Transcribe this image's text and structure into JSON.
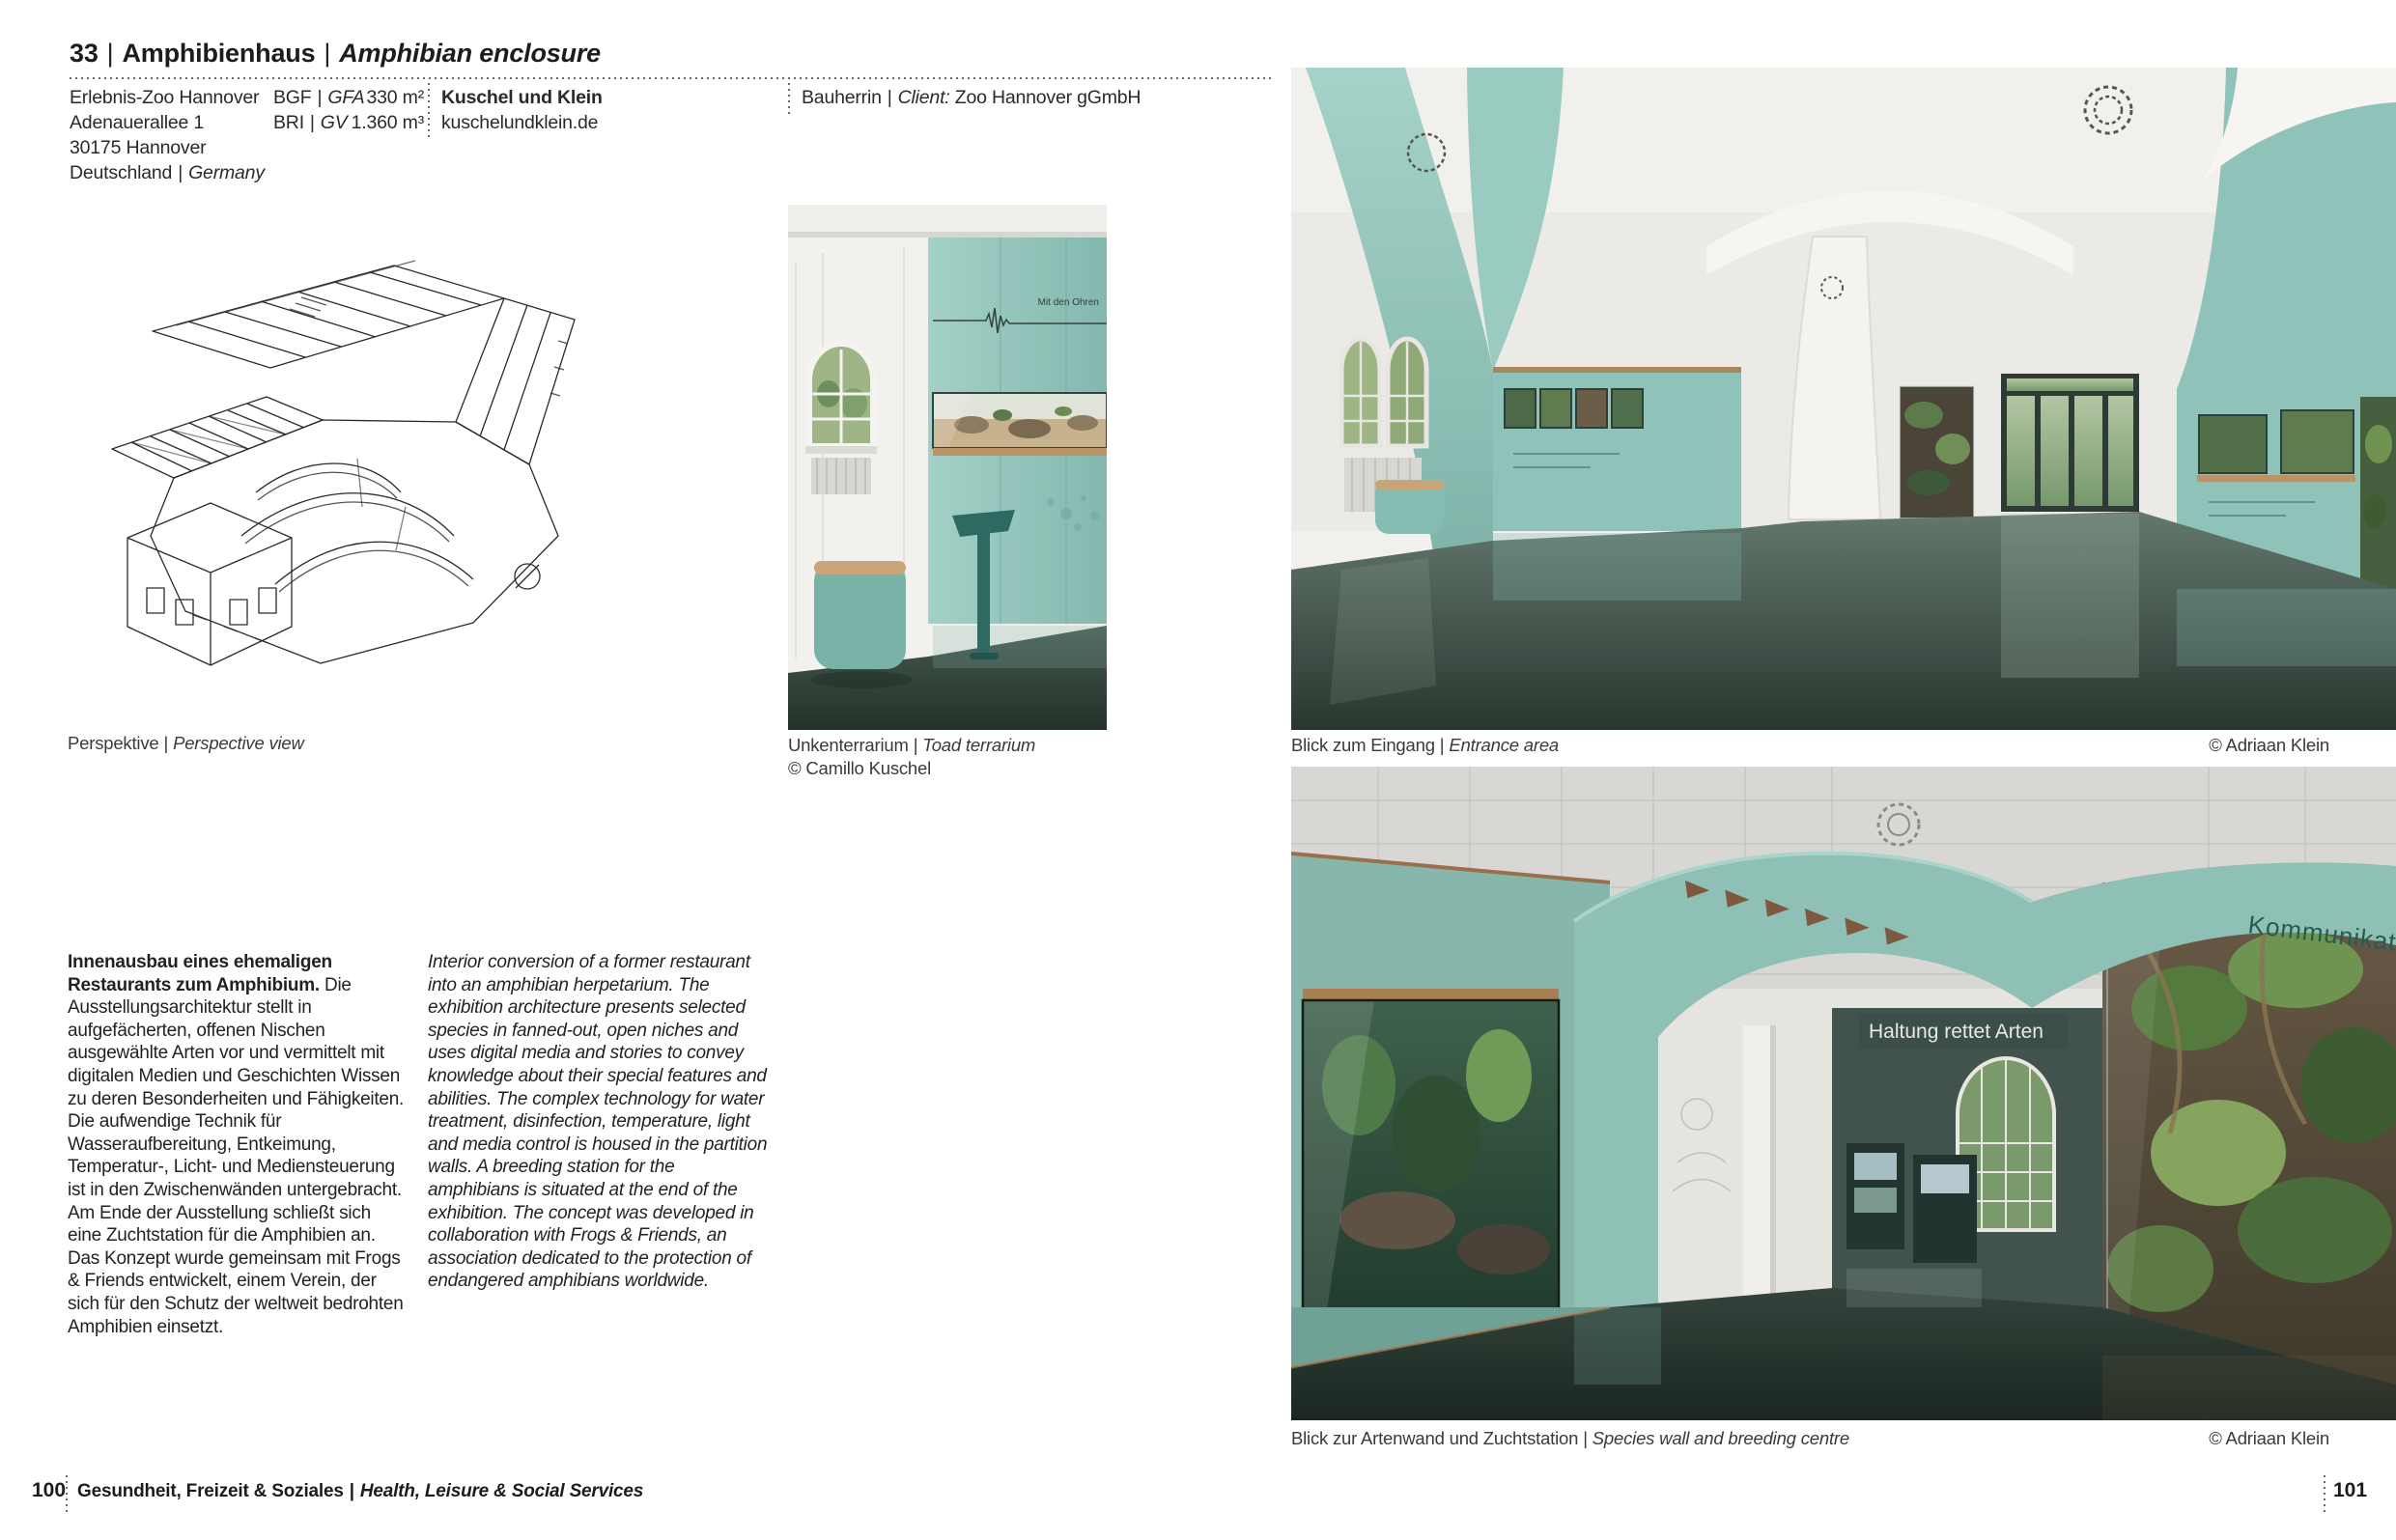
{
  "sep": "|",
  "header": {
    "number": "33",
    "title_de": "Amphibienhaus",
    "title_en": "Amphibian enclosure"
  },
  "info": {
    "org": "Erlebnis-Zoo Hannover",
    "street": "Adenauerallee 1",
    "city": "30175 Hannover",
    "country_de": "Deutschland",
    "country_en": "Germany",
    "metric1_de": "BGF",
    "metric1_en": "GFA",
    "metric1_value": "330 m²",
    "metric2_de": "BRI",
    "metric2_en": "GV",
    "metric2_value": "1.360 m³",
    "architect": "Kuschel und Klein",
    "website": "kuschelundklein.de",
    "client_de": "Bauherrin",
    "client_en": "Client:",
    "client_value": "Zoo Hannover gGmbH"
  },
  "captions": {
    "perspective_de": "Perspektive",
    "perspective_en": "Perspective view",
    "terrarium_de": "Unkenterrarium",
    "terrarium_en": "Toad terrarium",
    "terrarium_credit": "© Camillo Kuschel",
    "entrance_de": "Blick zum Eingang",
    "entrance_en": "Entrance area",
    "entrance_credit": "© Adriaan Klein",
    "species_de": "Blick zur Artenwand und Zuchtstation",
    "species_en": "Species wall and breeding centre",
    "species_credit": "© Adriaan Klein"
  },
  "body": {
    "de_lead": "Innenausbau eines ehemaligen Restaurants zum Amphibium.",
    "de_rest": " Die Ausstellungsarchitektur stellt in aufgefächerten, offenen Nischen ausgewählte Arten vor und vermittelt mit digitalen Medien und Geschichten Wissen zu deren Besonderheiten und Fähigkeiten. Die aufwendige Technik für Wasseraufbereitung, Entkeimung, Temperatur-, Licht- und Mediensteuerung ist in den Zwischenwänden untergebracht. Am Ende der Ausstellung schließt sich eine Zuchtstation für die Amphibien an. Das Konzept wurde gemeinsam mit Frogs & Friends entwickelt, einem Verein, der sich für den Schutz der weltweit bedrohten Amphibien einsetzt.",
    "en": "Interior conversion of a former restaurant into an amphibian herpetarium. The exhibition architecture presents selected species in fanned-out, open niches and uses digital media and stories to convey knowledge about their special features and abilities. The complex technology for water treatment, disinfection, temperature, light and media control is housed in the partition walls. A breeding station for the amphibians is situated at the end of the exhibition. The concept was developed in collaboration with Frogs & Friends, an association dedicated to the protection of endangered amphibians worldwide."
  },
  "photo_text": {
    "kommunikation": "Kommunikation",
    "haltung": "Haltung rettet Arten",
    "ohren": "Mit den Ohren"
  },
  "footer": {
    "page_left": "100",
    "section_de": "Gesundheit, Freizeit & Soziales",
    "section_en": "Health, Leisure & Social Services",
    "page_right": "101"
  },
  "colors": {
    "teal": "#8fc3ba",
    "teal_dark": "#6fa89d",
    "floor": "#2f3d36",
    "ink": "#1c1c1c"
  }
}
